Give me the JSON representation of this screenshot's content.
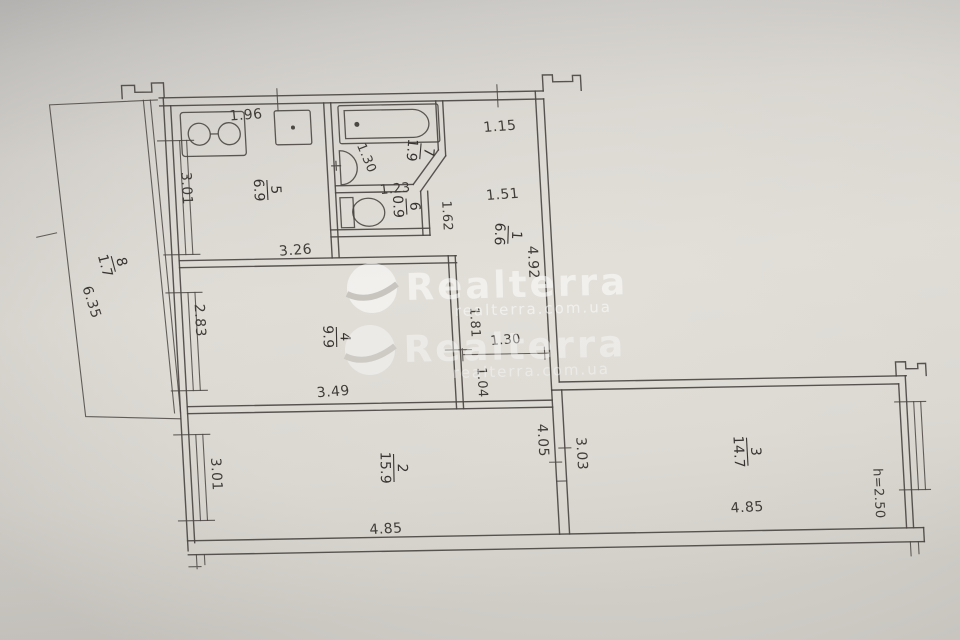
{
  "watermark": {
    "brand": "Realterra",
    "domain": "realterra.com.ua"
  },
  "rooms": {
    "r1": {
      "num": "1",
      "area": "6.6"
    },
    "r2": {
      "num": "2",
      "area": "15.9"
    },
    "r3": {
      "num": "3",
      "area": "14.7"
    },
    "r4": {
      "num": "4",
      "area": "9.9"
    },
    "r5": {
      "num": "5",
      "area": "6.9"
    },
    "r6": {
      "num": "6",
      "area": "0.9"
    },
    "r7": {
      "num": "7",
      "area": "1.9"
    },
    "r8": {
      "num": "8",
      "area": "1.7"
    }
  },
  "dimensions": {
    "kitchen_top": "1.96",
    "entry_top": "1.15",
    "kitchen_window": "3.01",
    "bath_width": "1.30",
    "wc_width": "1.23",
    "hall_width": "1.51",
    "wc_depth": "1.62",
    "hall_depth": "4.92",
    "room4_top": "3.26",
    "room4_window": "2.83",
    "room4_bottom": "3.49",
    "corridor_upper": "1.81",
    "corridor_opening": "1.30",
    "corridor_lower": "1.04",
    "balcony_length": "6.35",
    "room2_window": "3.01",
    "room2_bottom": "4.85",
    "room2_right": "4.05",
    "room3_left": "3.03",
    "room3_bottom": "4.85",
    "ceiling_height": "h=2.50"
  }
}
